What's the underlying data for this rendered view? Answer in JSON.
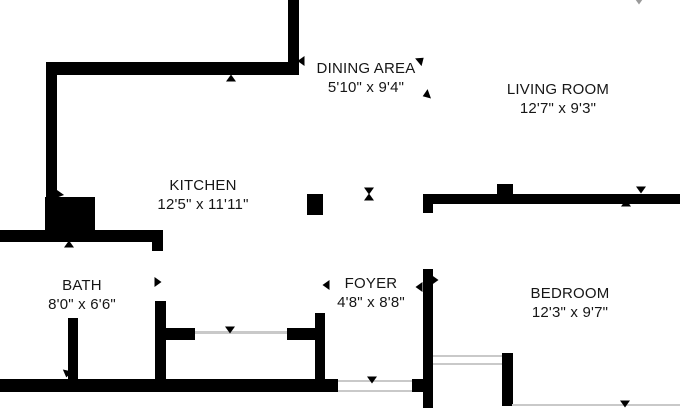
{
  "colors": {
    "wall": "#000000",
    "text": "#161616",
    "thin_line": "#c9c9c9",
    "background": "#ffffff",
    "faint_marker": "#9a9a9a"
  },
  "rooms": [
    {
      "name": "DINING AREA",
      "dimensions": "5'10\" x 9'4\"",
      "cx": 366,
      "top": 59
    },
    {
      "name": "LIVING ROOM",
      "dimensions": "12'7\" x 9'3\"",
      "cx": 558,
      "top": 80
    },
    {
      "name": "KITCHEN",
      "dimensions": "12'5\" x 11'11\"",
      "cx": 203,
      "top": 176
    },
    {
      "name": "BATH",
      "dimensions": "8'0\" x 6'6\"",
      "cx": 82,
      "top": 276
    },
    {
      "name": "FOYER",
      "dimensions": "4'8\" x 8'8\"",
      "cx": 371,
      "top": 274
    },
    {
      "name": "BEDROOM",
      "dimensions": "12'3\" x 9'7\"",
      "cx": 570,
      "top": 284
    }
  ],
  "plan": {
    "walls": [
      {
        "name": "wall-top-vertical",
        "x": 288,
        "y": 0,
        "w": 11,
        "h": 75
      },
      {
        "name": "wall-dining-kitchen-horizontal",
        "x": 46,
        "y": 62,
        "w": 253,
        "h": 13
      },
      {
        "name": "wall-left-vertical",
        "x": 46,
        "y": 62,
        "w": 11,
        "h": 136
      },
      {
        "name": "wall-closet-block",
        "x": 45,
        "y": 197,
        "w": 50,
        "h": 36
      },
      {
        "name": "wall-bath-top",
        "x": 0,
        "y": 230,
        "w": 163,
        "h": 12
      },
      {
        "name": "wall-bath-door-jamb-top",
        "x": 152,
        "y": 240,
        "w": 11,
        "h": 11
      },
      {
        "name": "wall-kitchen-bath-vertical",
        "x": 155,
        "y": 301,
        "w": 11,
        "h": 80
      },
      {
        "name": "wall-bath-door-jamb",
        "x": 68,
        "y": 318,
        "w": 10,
        "h": 62
      },
      {
        "name": "wall-bottom",
        "x": 0,
        "y": 379,
        "w": 338,
        "h": 13
      },
      {
        "name": "wall-bottom-stub",
        "x": 412,
        "y": 379,
        "w": 11,
        "h": 13
      },
      {
        "name": "wall-foyer-top-stub",
        "x": 423,
        "y": 195,
        "w": 10,
        "h": 18
      },
      {
        "name": "wall-foyer-bedroom-vertical",
        "x": 423,
        "y": 269,
        "w": 10,
        "h": 139
      },
      {
        "name": "wall-living-bedroom-horizontal",
        "x": 423,
        "y": 194,
        "w": 257,
        "h": 10
      },
      {
        "name": "column-bedroom-wall",
        "x": 497,
        "y": 184,
        "w": 16,
        "h": 11
      },
      {
        "name": "column-kitchen",
        "x": 307,
        "y": 194,
        "w": 16,
        "h": 21
      },
      {
        "name": "wall-closet-left-stub",
        "x": 157,
        "y": 328,
        "w": 38,
        "h": 12
      },
      {
        "name": "wall-closet-right-stub",
        "x": 287,
        "y": 328,
        "w": 30,
        "h": 12
      },
      {
        "name": "wall-closet-right-vertical",
        "x": 315,
        "y": 313,
        "w": 10,
        "h": 67
      },
      {
        "name": "wall-bedroom-bottom-jamb",
        "x": 502,
        "y": 353,
        "w": 11,
        "h": 53
      }
    ],
    "thin_lines": [
      {
        "name": "door-line-closet",
        "x": 195,
        "y": 331,
        "w": 92,
        "h": 3
      },
      {
        "name": "door-line-entry-top",
        "x": 338,
        "y": 380,
        "w": 74,
        "h": 2
      },
      {
        "name": "door-line-entry-bottom",
        "x": 338,
        "y": 390,
        "w": 74,
        "h": 2
      },
      {
        "name": "door-line-bedroom-top",
        "x": 433,
        "y": 355,
        "w": 69,
        "h": 2
      },
      {
        "name": "door-line-bedroom-bottom",
        "x": 433,
        "y": 363,
        "w": 69,
        "h": 2
      },
      {
        "name": "boundary-line-bottom-right",
        "x": 512,
        "y": 404,
        "w": 168,
        "h": 2
      }
    ],
    "markers": [
      {
        "name": "arrow-dining-wall-end",
        "dir": "left",
        "x": 301,
        "y": 61
      },
      {
        "name": "arrow-dining-open-top",
        "dir": "right",
        "x": 421,
        "y": 60,
        "rot": -40
      },
      {
        "name": "arrow-dining-open-bottom",
        "dir": "left",
        "x": 426,
        "y": 95,
        "rot": -20
      },
      {
        "name": "arrow-dining-wall-up",
        "dir": "up",
        "x": 231,
        "y": 78
      },
      {
        "name": "arrow-living-wall-down",
        "dir": "down",
        "x": 369,
        "y": 191
      },
      {
        "name": "arrow-living-wall-up",
        "dir": "up",
        "x": 369,
        "y": 197
      },
      {
        "name": "arrow-bedroom-wall-down",
        "dir": "down",
        "x": 641,
        "y": 190
      },
      {
        "name": "arrow-bedroom-wall-up",
        "dir": "up",
        "x": 626,
        "y": 203
      },
      {
        "name": "arrow-closet-block",
        "dir": "down",
        "x": 58,
        "y": 195,
        "rot": 35
      },
      {
        "name": "arrow-bath-wall-up",
        "dir": "up",
        "x": 69,
        "y": 244
      },
      {
        "name": "arrow-bath-kitchen-door",
        "dir": "right",
        "x": 158,
        "y": 282
      },
      {
        "name": "arrow-bath-door-down",
        "dir": "down",
        "x": 67,
        "y": 374,
        "rot": 12
      },
      {
        "name": "arrow-closet-door-down",
        "dir": "down",
        "x": 230,
        "y": 330
      },
      {
        "name": "arrow-entry-door-down",
        "dir": "down",
        "x": 372,
        "y": 380
      },
      {
        "name": "arrow-foyer-door-right",
        "dir": "right",
        "x": 435,
        "y": 280
      },
      {
        "name": "arrow-foyer-door-left",
        "dir": "left",
        "x": 419,
        "y": 287
      },
      {
        "name": "arrow-foyer-label-left",
        "dir": "left",
        "x": 326,
        "y": 285
      },
      {
        "name": "arrow-bottom-right-down",
        "dir": "down",
        "x": 625,
        "y": 404
      },
      {
        "name": "arrow-top-edge-faint",
        "dir": "down",
        "x": 639,
        "y": 1,
        "faint": true
      }
    ]
  }
}
